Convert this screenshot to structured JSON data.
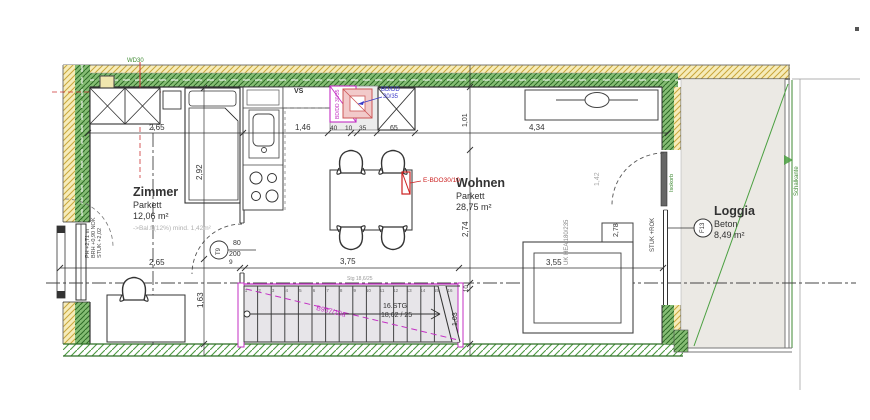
{
  "colors": {
    "wall_hatch_green": "#2e6b26",
    "insulation_yellow": "#f6ecba",
    "stair_magenta": "#c32fc3",
    "annotation_red": "#cc2020",
    "annotation_blue": "#3a3ac8",
    "annotation_green": "#3f8a33",
    "loggia_floor_gray": "#ebe9e4"
  },
  "rooms": {
    "zimmer": {
      "name": "Zimmer",
      "floor": "Parkett",
      "area": "12,06 m²",
      "note": "->Bal.f.(12%) mind. 1,42m²"
    },
    "wohnen": {
      "name": "Wohnen",
      "floor": "Parkett",
      "area": "28,75 m²"
    },
    "loggia": {
      "name": "Loggia",
      "floor": "Beton",
      "area": "8,49 m²",
      "tag": "F13"
    }
  },
  "door": {
    "tag": "T9",
    "width": "80",
    "height": "200"
  },
  "stair": {
    "steps_label": "16.STG",
    "ratio_label": "18,62 / 25",
    "note": "Stg 18,6/25",
    "flight_label": "B937/10a",
    "tread_numbers": [
      "1",
      "2",
      "3",
      "4",
      "5",
      "6",
      "7",
      "8",
      "9",
      "10",
      "11",
      "12",
      "13",
      "14",
      "15",
      "16"
    ]
  },
  "dimensions": {
    "top": {
      "zimmer_width": "2,65",
      "kitchen": "1,46",
      "shaft_a": "40",
      "shaft_b": "10",
      "shaft_c": "35",
      "chimney": "65",
      "wohnen_width": "4,34"
    },
    "bottom": {
      "zimmer": "2,65",
      "door_jamb": "9",
      "hall": "3,75",
      "wohnen": "3,55"
    },
    "vertical": {
      "bed": "2,92",
      "desk": "1,63",
      "top_right": "1,01",
      "mid_right": "2,74",
      "small_right": "10",
      "stair_right": "1,03",
      "loggia_door": "1,42",
      "sofa": "2,78"
    }
  },
  "annotations": {
    "vs": "VS",
    "bd_dd_line1": "BD/DD",
    "bd_dd_line2": "30/35",
    "shaft_text": "BD/DD 30/35",
    "e_bdo": "E-BDO30/10",
    "wd30": "WD30",
    "isokorb": "Isokorb",
    "schalkante": "Schalkante",
    "stuk_rok": "STUK +ROK",
    "uk_hea": "UK HEA 180/235",
    "window_ph": "PH +2,71 m",
    "window_brh": "BRH +0,90 NOK",
    "window_stuk": "STUK +2,02"
  }
}
